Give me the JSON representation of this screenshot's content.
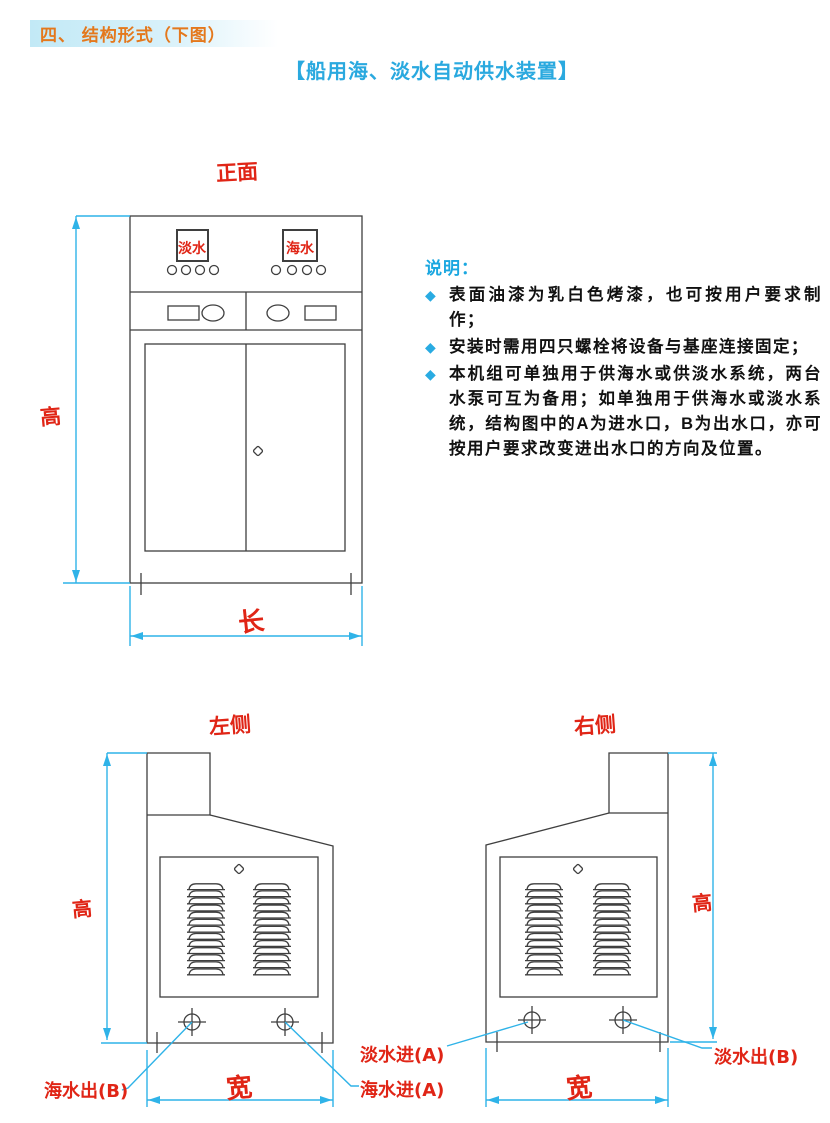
{
  "page": {
    "section_heading": "四、 结构形式（下图）",
    "subtitle": "【船用海、淡水自动供水装置】"
  },
  "notes": {
    "title": "说明：",
    "bullet_glyph": "◆",
    "bullet_color": "#29abe2",
    "items": [
      "表面油漆为乳白色烤漆，也可按用户要求制作；",
      "安装时需用四只螺栓将设备与基座连接固定；",
      "本机组可单独用于供海水或供淡水系统，两台水泵可互为备用；如单独用于供海水或淡水系统，结构图中的A为进水口，B为出水口，亦可按用户要求改变进出水口的方向及位置。"
    ]
  },
  "front_view": {
    "label": "正面",
    "panel_left_label": "淡水",
    "panel_right_label": "海水",
    "dim_height_label": "高",
    "dim_length_label": "长"
  },
  "left_view": {
    "label": "左侧",
    "dim_height_label": "高",
    "dim_width_label": "宽",
    "port_left_label": "海水出(B)",
    "port_right_label": "海水进(A)"
  },
  "right_view": {
    "label": "右侧",
    "dim_height_label": "高",
    "dim_width_label": "宽",
    "port_left_label": "淡水进(A)",
    "port_right_label": "淡水出(B)"
  },
  "colors": {
    "dimension_line": "#2fb3e8",
    "annotation_red": "#e02516",
    "heading_orange": "#e4781c",
    "subtitle_blue": "#2aa9df",
    "drawing_line": "#3f3f3f"
  }
}
